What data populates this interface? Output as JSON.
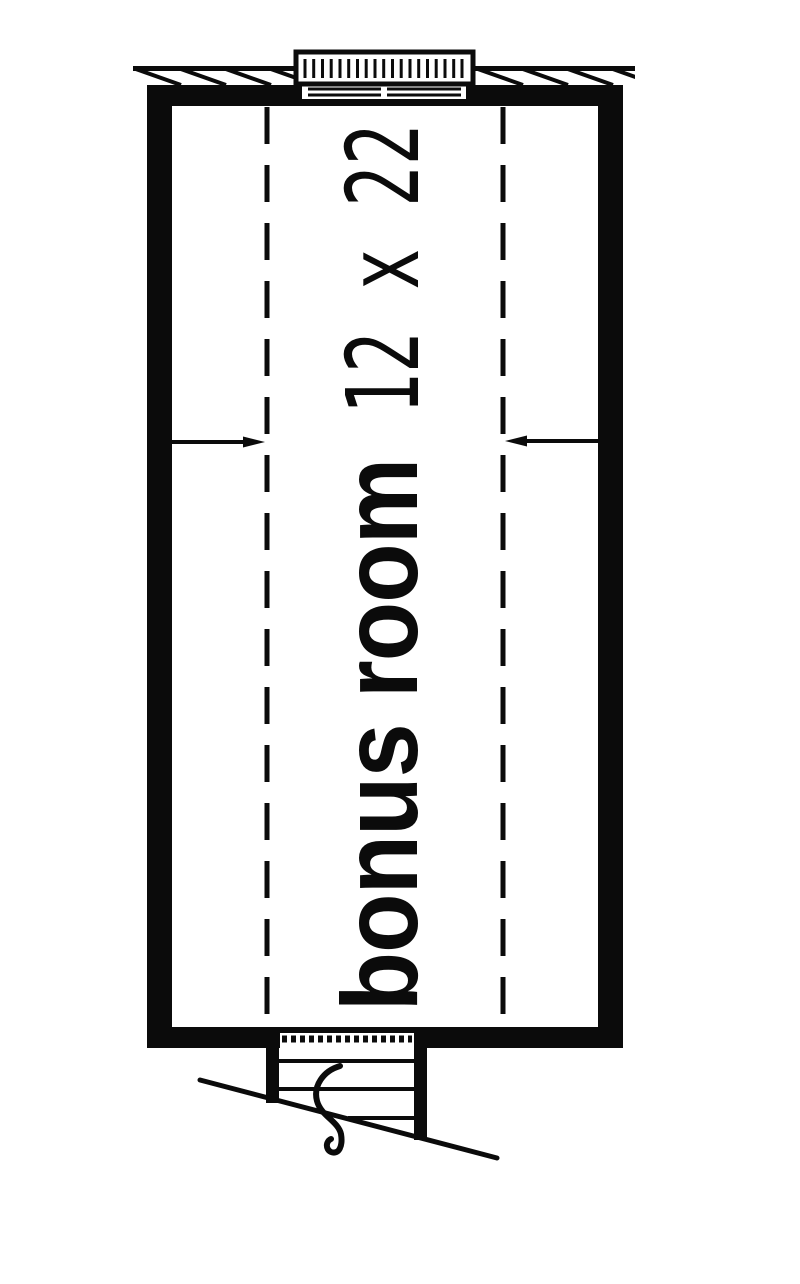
{
  "page": {
    "background_color": "#ffffff",
    "ink_color": "#0b0b0b"
  },
  "plan": {
    "room_label": "bonus room",
    "room_dimensions": "12 x 22",
    "symbols": {
      "top": "louvered-vent-window-with-roof-overhang-hatch",
      "interior": "knee-wall-dashed-lines-with-dimension-arrows",
      "bottom": "staircase-opening-with-diagonal-break-line"
    }
  }
}
